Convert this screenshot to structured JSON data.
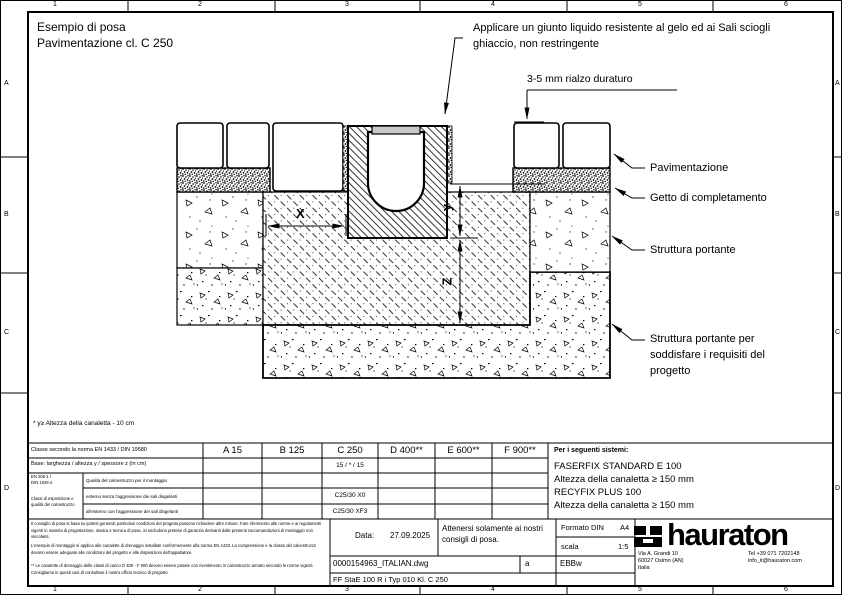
{
  "sheet": {
    "title1": "Esempio di posa",
    "title2": "Pavimentazione cl. C 250",
    "ruler": {
      "cols": [
        "1",
        "2",
        "3",
        "4",
        "5",
        "6"
      ],
      "rows": [
        "A",
        "B",
        "C",
        "D"
      ]
    }
  },
  "annotations": {
    "joint1": "Applicare un giunto liquido resistente al gelo ed ai Sali sciogli",
    "joint2": "ghiaccio, non restringente",
    "rialzo": "3-5 mm rialzo duraturo",
    "pavimentazione": "Pavimentazione",
    "getto": "Getto di completamento",
    "struttura": "Struttura portante",
    "struttura2_1": "Struttura portante per",
    "struttura2_2": "soddisfare i requisiti del",
    "struttura2_3": "progetto",
    "dim_x": "X",
    "dim_y": "y",
    "dim_z": "Z",
    "footnote": "* y≥ Altezza della canaletta - 10 cm"
  },
  "class_table": {
    "row1_label": "Classe secondo la norma EN 1433 / DIN 19580",
    "row2_label": "Base:  larghezza / altezza y / spessore z (in cm)",
    "classes": [
      "A 15",
      "B 125",
      "C 250",
      "D 400**",
      "E 600**",
      "F 900**"
    ],
    "base_c250": "15 / * / 15",
    "group": [
      "EN 206-1 /",
      "DIN 1045-2",
      "Classi di esposizione e",
      "qualità del calcestruzzo"
    ],
    "rows": [
      {
        "label": "Qualità del calcestruzzo per il montaggio",
        "c250": ""
      },
      {
        "label": "esterno senza l'aggressione dei sali disgelanti",
        "c250": "C25/30 X0"
      },
      {
        "label": "all'esterno con l'aggressione dei sali disgelanti",
        "c250": "C25/30 XF3"
      }
    ]
  },
  "systems_panel": {
    "heading": "Per i seguenti sistemi:",
    "lines": [
      "FASERFIX STANDARD E 100",
      "Altezza della canaletta ≥ 150 mm",
      "RECYFIX PLUS 100",
      "Altezza della canaletta ≥ 150 mm"
    ]
  },
  "title_block": {
    "disclaimer_p1": "Il consiglio di posa si basa su ipotesi generali; particolari condizioni del progetto possono richiedere altre misure. Fare riferimento alle norme e ai regolamenti vigenti in materia di progettazione, statica e tecnica di posa. Si escludono pretese di garanzia derivanti dalle presenti raccomandazioni di montaggio non vincolanti.",
    "disclaimer_p2": "L'esempio di montaggio si applica alle canalette di drenaggio installate conformemente alla norma EN 1433. La compressione e la classe del calcestruzzo devono essere adeguate alle condizioni del progetto e alle disposizioni dell'appaltatore.",
    "disclaimer_p3": "** Le canalette di drenaggio delle classi di carico D 400 - F 900 devono essere posate con rivestimento in calcestruzzo armato secondo le norme vigenti. Consigliamo in questi casi di consultare il nostro ufficio tecnico di progetto.",
    "data_label": "Data:",
    "data_value": "27.09.2025",
    "note": "Attenersi solamente ai nostri consigli di posa.",
    "formato_label": "Formato DIN",
    "formato_value": "A4",
    "scala_label": "scala",
    "scala_value": "1:5",
    "file_name": "0000154963_ITALIAN.dwg",
    "revision": "a",
    "author": "EBBw",
    "doc_code": "FF  StaE 100 R i Typ 010 Kl. C 250",
    "logo_text": "hauraton",
    "address1": "Via A. Grandi 10",
    "address2": "60027 Osimo (AN)",
    "address3": "Italia",
    "phone": "Tel +39 071 7202148",
    "email": "info_it@hauraton.com"
  }
}
